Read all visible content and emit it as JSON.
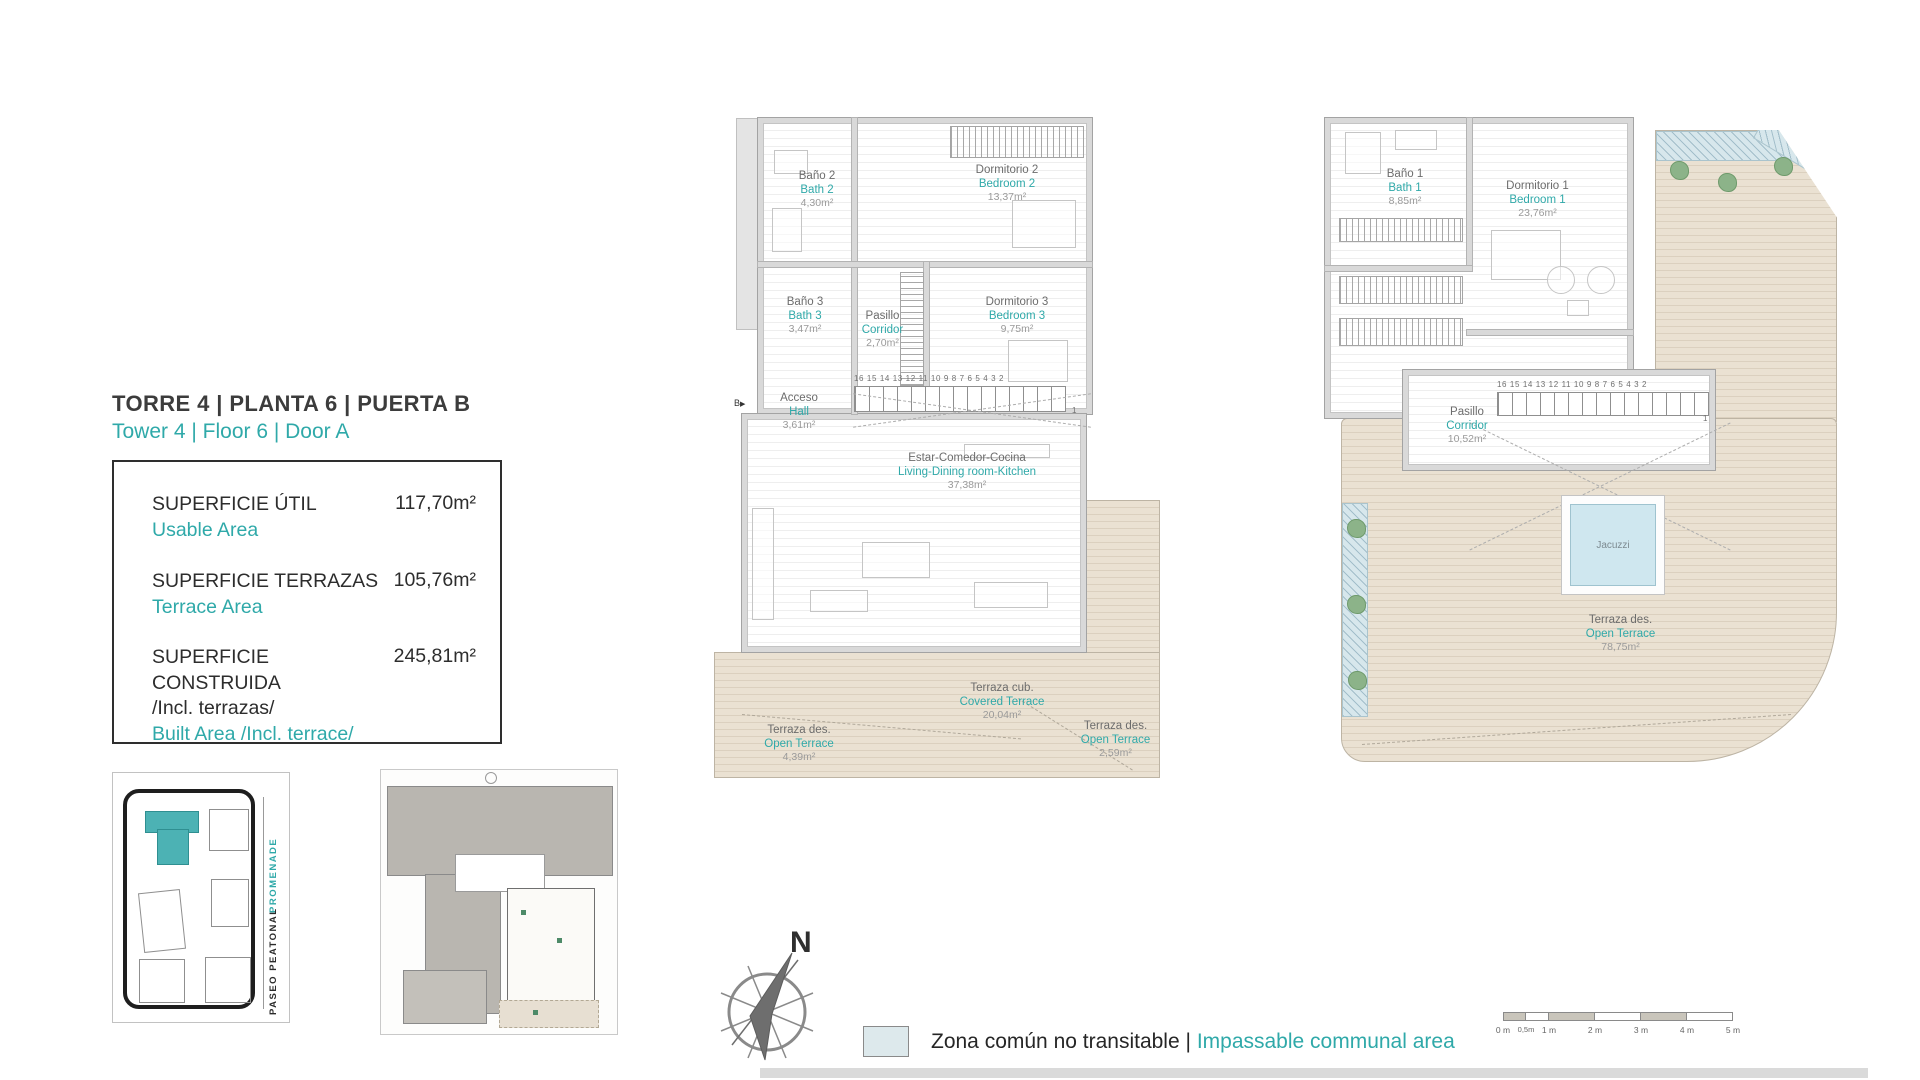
{
  "colors": {
    "accent": "#2FA9A9",
    "terrace_floor": "#EAE1D2",
    "communal_area": "#D7E7EC",
    "jacuzzi_water": "#CFE7EF",
    "highlight_building": "#4CB2B4"
  },
  "header": {
    "title_es": "TORRE 4 | PLANTA 6 | PUERTA B",
    "title_en": "Tower 4 | Floor 6 | Door A"
  },
  "area_table": {
    "rows": [
      {
        "label_es": "SUPERFICIE ÚTIL",
        "label_es2": "",
        "label_en": "Usable Area",
        "value": "117,70m²"
      },
      {
        "label_es": "SUPERFICIE TERRAZAS",
        "label_es2": "",
        "label_en": "Terrace Area",
        "value": "105,76m²"
      },
      {
        "label_es": "SUPERFICIE CONSTRUIDA",
        "label_es2": "/Incl. terrazas/",
        "label_en": "Built Area /Incl. terrace/",
        "value": "245,81m²"
      }
    ]
  },
  "main_plan": {
    "entrance_label": "B",
    "stair_numbers": "16 15 14 13 12 11 10 9 8 7 6 5 4 3 2",
    "stair_end": "1",
    "rooms": {
      "bano2": {
        "es": "Baño 2",
        "en": "Bath 2",
        "area": "4,30m²"
      },
      "dormitorio2": {
        "es": "Dormitorio 2",
        "en": "Bedroom 2",
        "area": "13,37m²"
      },
      "bano3": {
        "es": "Baño 3",
        "en": "Bath 3",
        "area": "3,47m²"
      },
      "pasillo": {
        "es": "Pasillo",
        "en": "Corridor",
        "area": "2,70m²"
      },
      "dormitorio3": {
        "es": "Dormitorio 3",
        "en": "Bedroom 3",
        "area": "9,75m²"
      },
      "acceso": {
        "es": "Acceso",
        "en": "Hall",
        "area": "3,61m²"
      },
      "estar": {
        "es": "Estar-Comedor-Cocina",
        "en": "Living-Dining room-Kitchen",
        "area": "37,38m²"
      },
      "terraza_cubierta": {
        "es": "Terraza cub.",
        "en": "Covered Terrace",
        "area": "20,04m²"
      },
      "terraza_descubierta_1": {
        "es": "Terraza des.",
        "en": "Open Terrace",
        "area": "4,39m²"
      },
      "terraza_descubierta_2": {
        "es": "Terraza des.",
        "en": "Open Terrace",
        "area": "2,59m²"
      }
    }
  },
  "upper_plan": {
    "stair_numbers": "16 15 14 13 12 11 10 9 8 7 6 5 4 3 2",
    "stair_end": "1",
    "jacuzzi_label": "Jacuzzi",
    "rooms": {
      "bano1": {
        "es": "Baño 1",
        "en": "Bath 1",
        "area": "8,85m²"
      },
      "dormitorio1": {
        "es": "Dormitorio 1",
        "en": "Bedroom 1",
        "area": "23,76m²"
      },
      "pasillo": {
        "es": "Pasillo",
        "en": "Corridor",
        "area": "10,52m²"
      },
      "terraza_descubierta": {
        "es": "Terraza des.",
        "en": "Open Terrace",
        "area": "78,75m²"
      }
    }
  },
  "site_map": {
    "street_inner": "PASEO PEATONAL",
    "street_outer": "PROMENADE"
  },
  "compass": {
    "north": "N"
  },
  "legend": {
    "label_es": "Zona común no transitable",
    "separator": "|",
    "label_en": "Impassable communal area"
  },
  "scale_bar": {
    "labels": [
      "0 m",
      "0,5m",
      "1 m",
      "2 m",
      "3 m",
      "4 m",
      "5 m"
    ]
  }
}
